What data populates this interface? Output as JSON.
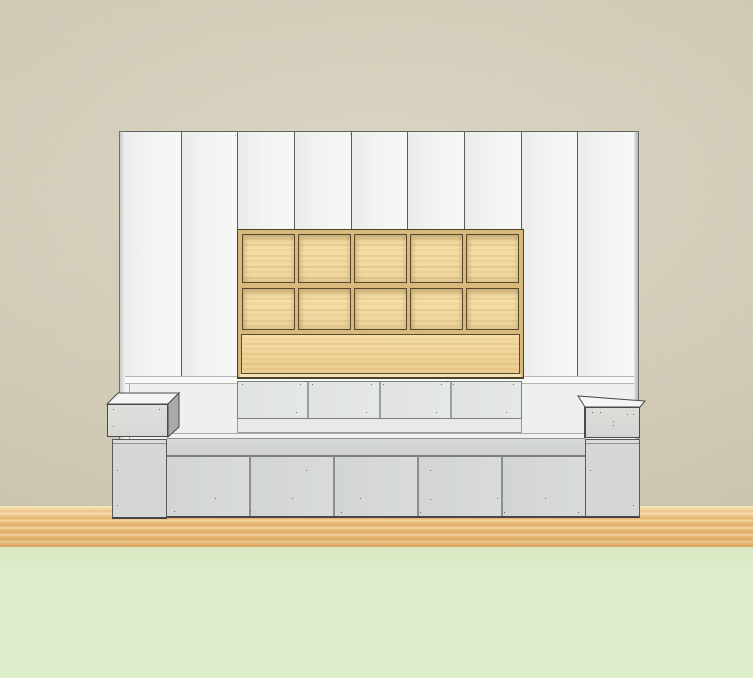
{
  "colors": {
    "wall": "#d7d1bd",
    "floorGreen": "#deeecb",
    "panelHi": "#f6f8f5",
    "panelLo": "#e9ece9",
    "panelLine": "#5a5d5a",
    "woodFrame": "#d9b87c",
    "woodDark": "#4e402a",
    "drawer": "#e5e8e5",
    "platform": "#edf0ed",
    "bench": "#cfd2cf",
    "door": "#d8dbd7",
    "column": "#d5d7d4",
    "boxTop": "#f5f6f3",
    "boxSide": "#a8aaa7"
  },
  "scene": {
    "description": "Elevation render of a built-in wall unit: nine tall white wardrobe panels, an inset wooden cubby shelf of five columns by two rows over a solid wood panel, four recessed drawers, a bench platform with five base cabinet doors, flanked by two gray pedestals with small top boxes, standing on a wood floor strip with a green foreground floor.",
    "tall_panel_count": 9,
    "cubby_columns": 5,
    "cubby_rows": 2,
    "drawer_count": 4,
    "door_count": 5,
    "pedestal_count": 2
  }
}
